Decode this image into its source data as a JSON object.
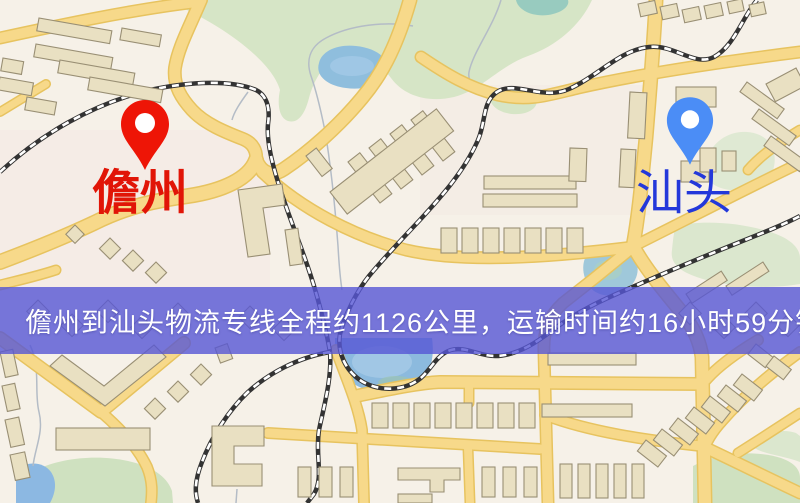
{
  "map": {
    "markers": {
      "origin": {
        "name": "儋州",
        "pin_color": "#ee1506",
        "label_color": "#e11507"
      },
      "destination": {
        "name": "汕头",
        "pin_color": "#4b8df6",
        "label_color": "#2338da"
      }
    },
    "banner": {
      "text": "儋州到汕头物流专线全程约1126公里，运输时间约16小时59分钟.",
      "origin": "儋州",
      "destination": "汕头",
      "distance_text": "约1126公里",
      "duration_text": "约16小时59分钟",
      "bg_color": "#5656d4",
      "text_color": "#ffffff"
    },
    "palette": {
      "background": "#f6f1e8",
      "road_fill": "#f7d98a",
      "road_casing": "#e7c35f",
      "building_fill": "#e9e0c2",
      "building_stroke": "#998f74",
      "park_green": "#d6e5c6",
      "water_blue": "#8fbedd",
      "railway": "#333333"
    }
  }
}
